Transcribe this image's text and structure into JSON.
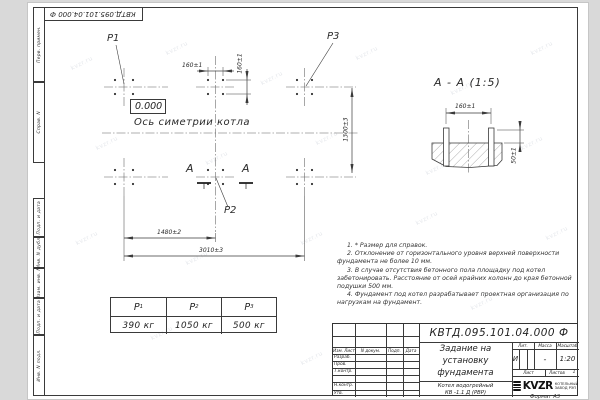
{
  "sheet": {
    "doc_number_top": "КВТД.095.101.04.000 Ф",
    "format_label": "Формат А3",
    "margin_labels": [
      "Перв. примен.",
      "Справ. N",
      "Подп. и дата",
      "Инв. N дубл.",
      "Взам. инв. N",
      "Подп. и дата",
      "Инв. N подл."
    ],
    "watermarks": {
      "text": "kvzr.ru",
      "positions": [
        [
          70,
          60
        ],
        [
          165,
          45
        ],
        [
          260,
          75
        ],
        [
          355,
          50
        ],
        [
          450,
          85
        ],
        [
          530,
          45
        ],
        [
          95,
          140
        ],
        [
          205,
          155
        ],
        [
          315,
          135
        ],
        [
          425,
          165
        ],
        [
          520,
          140
        ],
        [
          75,
          235
        ],
        [
          185,
          255
        ],
        [
          300,
          235
        ],
        [
          415,
          215
        ],
        [
          150,
          330
        ],
        [
          300,
          355
        ],
        [
          470,
          300
        ],
        [
          545,
          230
        ]
      ]
    }
  },
  "plan": {
    "p1_label": "P1",
    "p2_label": "P2",
    "p3_label": "P3",
    "elevation": "0.000",
    "axis_label": "Ось симетрии котла",
    "section_letter_left": "А",
    "section_letter_right": "А",
    "dim_bolt_x": "160±1",
    "dim_bolt_y": "160±1",
    "dim_rows": "1300±3",
    "dim_half": "1480±2",
    "dim_total": "3010±3"
  },
  "section": {
    "title": "А - А (1:5)",
    "dim_bolt": "160±1",
    "dim_height": "50±1"
  },
  "loads": {
    "items": [
      {
        "name": "P",
        "sub": "1",
        "value": "390 кг"
      },
      {
        "name": "P",
        "sub": "2",
        "value": "1050 кг"
      },
      {
        "name": "P",
        "sub": "3",
        "value": "500 кг"
      }
    ]
  },
  "notes": [
    "1. * Размер для справок.",
    "2. Отклонение от горизонтального уровня верхней поверхности фундамента не более 10 мм.",
    "3. В случае отсутствия бетонного пола площадку под котел забетонировать. Расстояние от осей крайних колонн до края бетонной подушки 500 мм.",
    "4. Фундамент под котел разрабатывает проектная организация по нагрузкам на фундамент."
  ],
  "stamp": {
    "doc_number": "КВТД.095.101.04.000 Ф",
    "title_lines": [
      "Задание на",
      "установку",
      "фундамента"
    ],
    "product_lines": [
      "Котел водогрейный",
      "КВ -1.1 Д  (РВР)"
    ],
    "hdr_izm": "Изм. Лист",
    "hdr_doc": "N докум.",
    "hdr_podp": "Подп.",
    "hdr_data": "Дата",
    "roles": [
      "Разраб.",
      "Пров.",
      "Т.контр.",
      "",
      "Н.контр.",
      "Утв."
    ],
    "lit_label": "Лит.",
    "mass_label": "Масса",
    "scale_label": "Масштаб",
    "lit_value": "И",
    "mass_value": "-",
    "scale_value": "1:20",
    "sheet_label": "Лист",
    "sheets_label": "Листов",
    "sheets_value": "1",
    "logo_text": "KVZR",
    "company_line1": "КОТЕЛЬНЫЙ",
    "company_line2": "ЗАВОД РЭП"
  }
}
